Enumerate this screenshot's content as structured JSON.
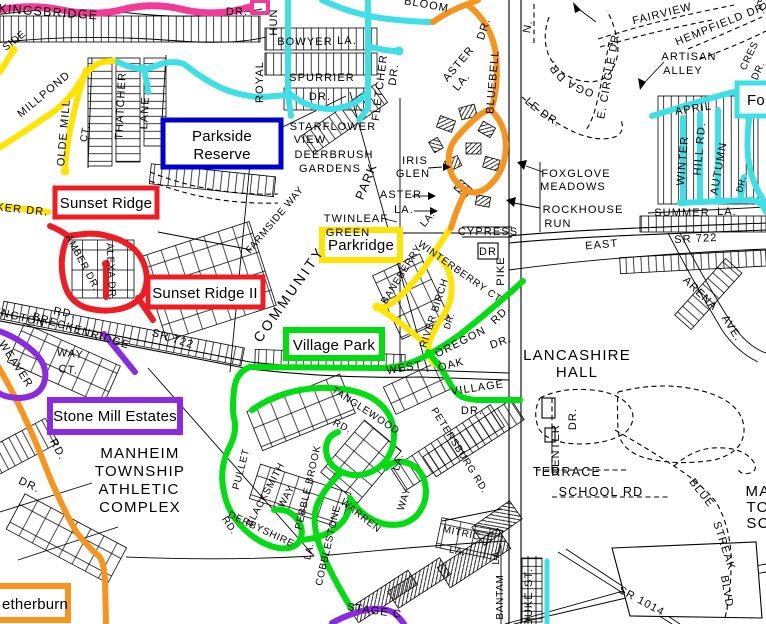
{
  "c": {
    "pink": "#f23b96",
    "yellow": "#ffe400",
    "cyan": "#3fdfe8",
    "orange": "#f7941e",
    "red": "#ee1c23",
    "purple": "#8a2be2",
    "green": "#00dd11",
    "blue": "#0000cc",
    "black": "#000000"
  },
  "boxes": {
    "parkside_reserve": {
      "line1": "Parkside",
      "line2": "Reserve",
      "color": "#0000cc"
    },
    "sunset_ridge": {
      "label": "Sunset Ridge",
      "color": "#ee1c23"
    },
    "sunset_ridge_2": {
      "label": "Sunset Ridge II",
      "color": "#ee1c23"
    },
    "parkridge": {
      "label": "Parkridge",
      "color": "#ffe400"
    },
    "village_park": {
      "label": "Village Park",
      "color": "#00dd11"
    },
    "stone_mill": {
      "label": "Stone Mill Estates",
      "color": "#8a2be2"
    },
    "netherburn": {
      "label": "etherburn",
      "color": "#f7941e"
    },
    "fo": {
      "label": "Fo",
      "color": "#3fdfe8"
    }
  },
  "t": {
    "kingsbridge": "KINGSBRIDGE",
    "dr_top": "DR.",
    "side": "SIDE",
    "millpond": "MILLPOND",
    "olde_mill": "OLDE MILL",
    "olde_mill_ct": "CT.",
    "thatcher": "THATCHER",
    "thatcher_lane": "LANE",
    "ker_dr": "KER DR.",
    "bowyer": "BOWYER",
    "bowyer_la": "LA.",
    "spurrier": "SPURRIER",
    "spurrier_dr": "DR.",
    "royal": "ROYAL",
    "hun": "HUN",
    "fletcher": "FLETCHER",
    "fletcher_dr": "DR.",
    "starflower": "STARFLOWER",
    "starflower_view": "VIEW",
    "deerbrush": "DEERBRUSH",
    "deerbrush_gardens": "GARDENS",
    "park": "PARK",
    "community": "COMMUNITY",
    "farmside": "FARMSIDE WAY",
    "amber": "AMBER DR.",
    "alexa": "ALEXA DR.",
    "rd_brk": "RD.",
    "lington": "LINGTON",
    "breckenridge": "BRECKENRIDGE",
    "sr722_left": "SR 722",
    "way_stone": "WAY",
    "ct_stone": "CT.",
    "weaver": "WEAVER",
    "weaver_rd": "RD.",
    "weaver_dr": "DR.",
    "manheim": "MANHEIM",
    "township": "TOWNSHIP",
    "athletic": "ATHLETIC",
    "complex": "COMPLEX",
    "twinleaf": "TWINLEAF",
    "twinleaf_green": "GREEN",
    "aster_h": "ASTER",
    "aster_h_la": "LA.",
    "aster_d": "ASTER",
    "aster_d_la": "LA.",
    "iris": "IRIS",
    "glen": "GLEN",
    "cypress": "CYPRESS",
    "cypress_dr": "DR",
    "pike": "PIKE",
    "baneberry": "BANEBERRY",
    "baneberry_la": "LA.",
    "winterberry": "WINTERBERRY CT",
    "river_birch": "RIVER BIRCH",
    "river_birch_dr": "DR.",
    "oregon": "OREGON",
    "oregon_rd": "RD.",
    "oregon_dr": "DR.",
    "west": "WEST",
    "oak": "OAK",
    "village": "VILLAGE",
    "village_dr": "DR.",
    "petersburg": "PETERSBURG RD.",
    "tanglewood": "TANGLEWOOD",
    "tanglewood_rd": "RD.",
    "tanglewood_la": "LA.",
    "blacksmith": "BLACKSMITH",
    "blacksmith_way": "WAY",
    "pebble": "PEBBLE BROOK",
    "warren": "WARREN",
    "warren_way": "WAY",
    "pullet": "PULLET",
    "derbyshire": "DERBYSHIRE",
    "derbyshire_rd": "RD.",
    "cobblestone": "COBBLESTONE",
    "cobblestone_la": "LA.",
    "stage": "STAGE C",
    "mitric": "MITRIC",
    "mitric_la": "LA.",
    "bantam": "BANTAM",
    "bantam_la": "LA.",
    "duke": "DUKE ST.",
    "sr1014": "SR 1014",
    "school_rd": "SCHOOL RD",
    "terrace": "TERRACE",
    "center": "CENTER",
    "center_dr": "DR.",
    "lancashire": "LANCASHIRE",
    "hall": "HALL",
    "blue": "BLUE",
    "streak": "STREAK",
    "blvd": "BLVD.",
    "ma": "MA",
    "to": "TO",
    "sc": "SC",
    "east": "EAST",
    "sr722_right": "SR 722",
    "arena": "ARENA",
    "arena_ave": "AVE.",
    "summer": "SUMMER",
    "summer_la": "LA.",
    "foxglove": "FOXGLOVE",
    "meadows": "MEADOWS",
    "rockhouse": "ROCKHOUSE",
    "run": "RUN",
    "fairview": "FAIRVIEW",
    "hempfield": "HEMPFIELD DR.",
    "artisan": "ARTISAN",
    "alley": "ALLEY",
    "conestoga": "CONESTOGA DR.",
    "e_circle": "E. CIRCLE DR.",
    "s_circle": "S. CIRCLE DR.",
    "n_frag": "N.",
    "cres": "CRES",
    "cres_dr": "DR.",
    "rd_tr": "RD.",
    "april": "APRIL",
    "winter": "WINTER",
    "hill_rd": "HILL RD.",
    "autumn": "AUTUMN",
    "autumn_dr": "DR.",
    "bloom": "BLOOM",
    "bluebell": "BLUEBELL",
    "bluebell_dr": "DR."
  }
}
